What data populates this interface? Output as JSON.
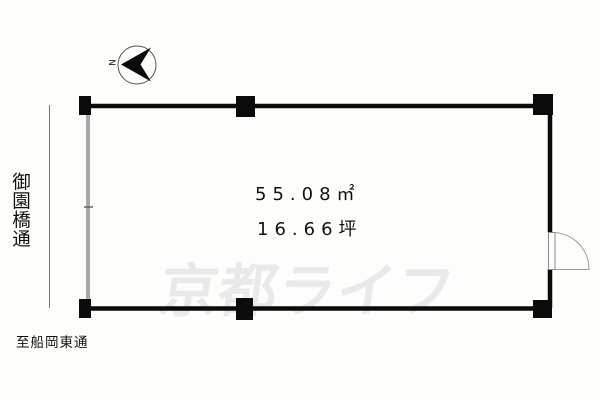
{
  "compass": {
    "north_label": "N"
  },
  "streets": {
    "left_vertical": "御園橋通",
    "bottom": "至船岡東通"
  },
  "area": {
    "square_meters": "55.08㎡",
    "tsubo": "16.66坪"
  },
  "watermark": {
    "text": "京都ライフ"
  },
  "colors": {
    "wall": "#0b0b0b",
    "left_wall": "#a9a9a9",
    "road_line": "#777777",
    "door": "#9a9a9a",
    "compass_ring": "#555555",
    "watermark": "#e9e9eb"
  }
}
